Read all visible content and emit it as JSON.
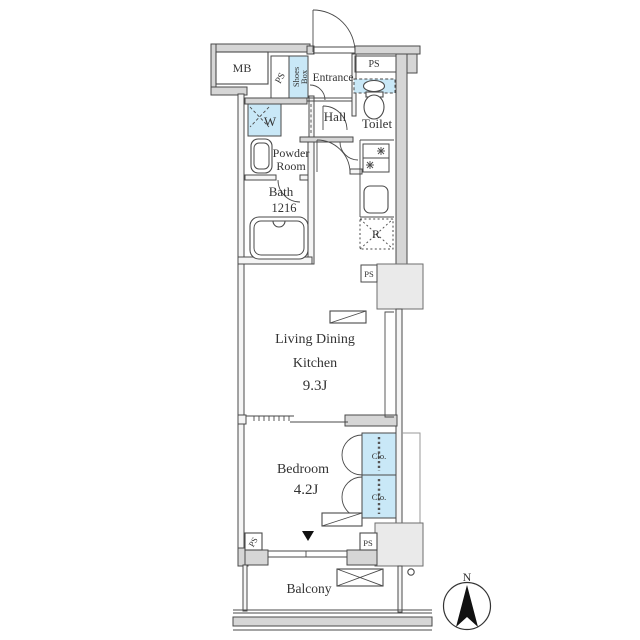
{
  "floorplan": {
    "rooms": {
      "entrance": "Entrance",
      "hall": "Hall",
      "toilet": "Toilet",
      "powder_line1": "Powder",
      "powder_line2": "Room",
      "bath": "Bath",
      "bath_size": "1216",
      "ldk_line1": "Living Dining",
      "ldk_line2": "Kitchen",
      "ldk_size": "9.3J",
      "bedroom": "Bedroom",
      "bedroom_size": "4.2J",
      "balcony": "Balcony"
    },
    "fixtures": {
      "meter_box": "MB",
      "pipe_space": "PS",
      "shoes_box_line1": "Shoes",
      "shoes_box_line2": "Box",
      "washing_machine": "W",
      "refrigerator": "R",
      "closet": "Clo."
    },
    "compass": {
      "north": "N"
    },
    "colors": {
      "highlight_blue": "#c9e8f7",
      "wall_gray": "#d6d6d6",
      "pillar_gray": "#eaeaea",
      "line": "#4a4a4a",
      "text": "#333333"
    }
  }
}
